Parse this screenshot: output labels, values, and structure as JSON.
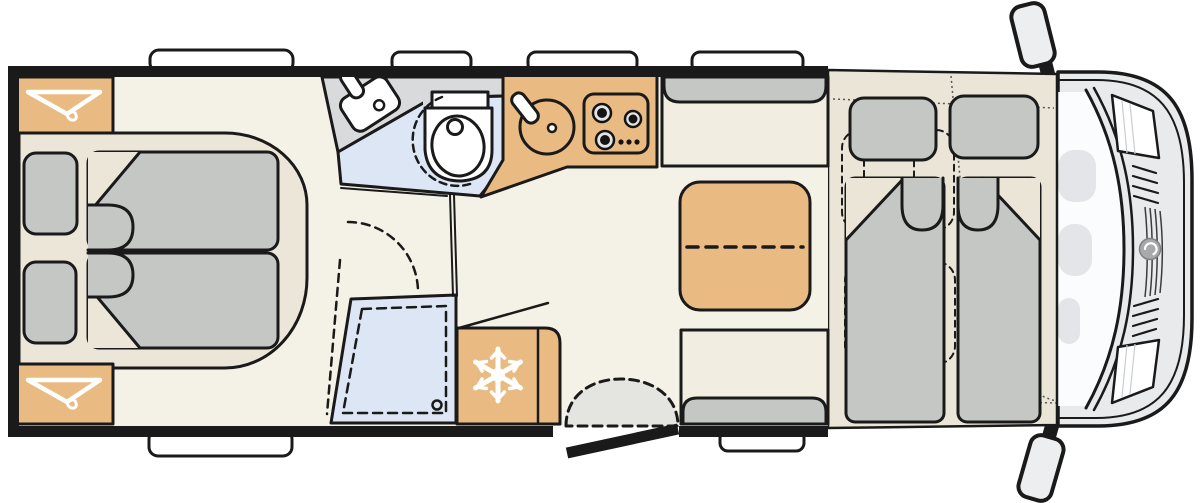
{
  "title": "motorhome-floor-plan",
  "colors": {
    "wall": "#1A1A1A",
    "floor": "#F4F1E7",
    "platform": "#EBE6D8",
    "overcab_bed_base": "#EAE5D7",
    "furniture_tan": "#E9BA81",
    "furniture_gray": "#C4C7C4",
    "bathroom_gray": "#D8DADC",
    "wet_blue": "#DCE6F4",
    "seat_beige": "#F1EDE0",
    "step_gray": "#E4E4E0",
    "cab_body": "#E9EAEC",
    "glass": "#FBFCFD",
    "dash_blob": "#E3E5E8",
    "mirror_gray": "#EDEEF0",
    "logo_gray": "#A6AAAD",
    "white": "#FFFFFF"
  },
  "icons": {
    "wardrobe_front": "hanger-icon",
    "wardrobe_rear": "hanger-icon",
    "fridge": "snowflake-icon",
    "vehicle_front": "brand-swirl-icon"
  },
  "regions": {
    "rear_bedroom": "twin-single-beds-with-pillows",
    "wardrobes": 2,
    "washroom": "corner-sink-and-swivel-toilet",
    "shower": "shower-tray-with-drain",
    "kitchen": "round-sink-and-three-burner-hob",
    "fridge": "refrigerator",
    "dinette": "two-benches-with-folding-table",
    "entry": "open-door-with-entry-step",
    "front_bed": "pull-down-double-bed-over-cab",
    "cab": "driver-cab-with-two-swivel-seats",
    "roof_windows_top": 4,
    "windows_bottom": 2,
    "mirrors": 2
  }
}
